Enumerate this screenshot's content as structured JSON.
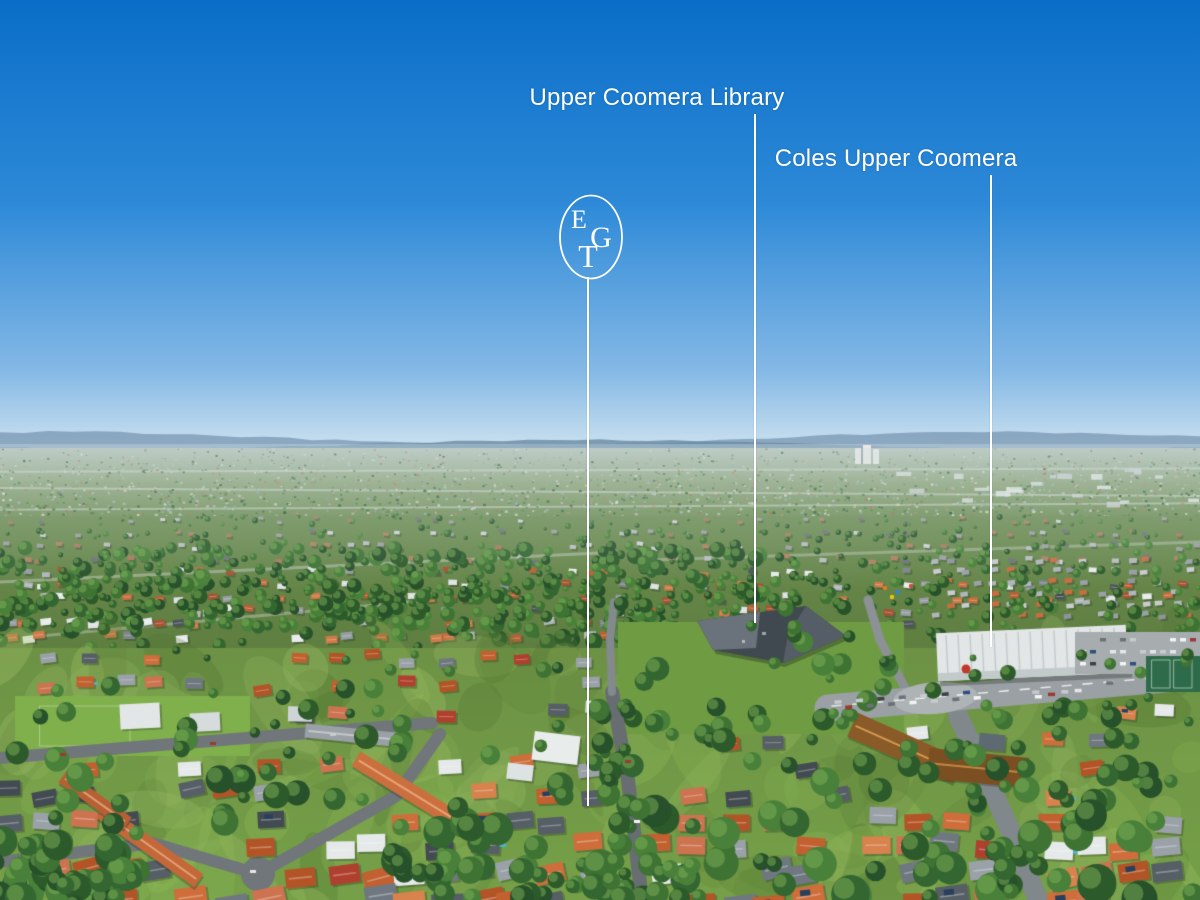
{
  "annotations": {
    "library_label": "Upper Coomera Library",
    "coles_label": "Coles Upper Coomera"
  },
  "logo": {
    "letter_top": "E",
    "letter_middle": "G",
    "letter_bottom": "T"
  },
  "colors": {
    "annotation": "#ffffff",
    "sky_top": "#0a6ec8",
    "sky_mid": "#2e8ad8",
    "sky_horizon": "#cfe3f0",
    "hills": "#7896b0",
    "vegetation": "#3e7334",
    "grass": "#76a048",
    "roof_terracotta": "#c2602f",
    "roof_gray": "#79828a",
    "road": "#70767a",
    "library_roof": "#414950",
    "coles_roof": "#e2e6e7"
  }
}
